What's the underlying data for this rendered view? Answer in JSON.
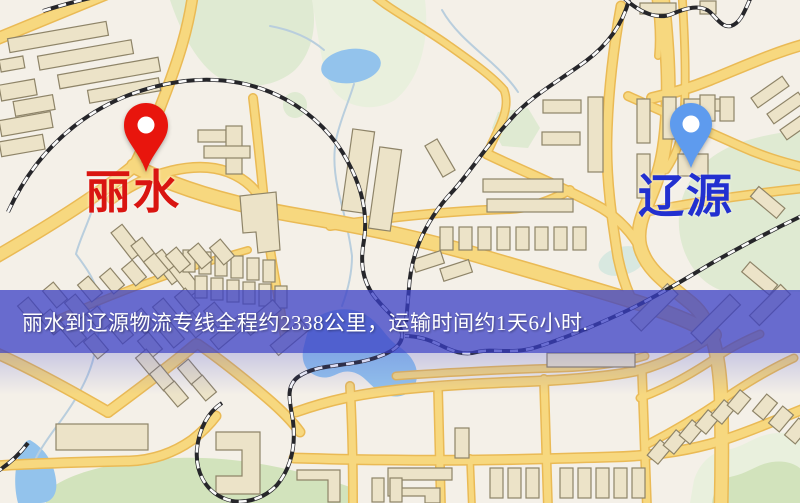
{
  "map": {
    "colors": {
      "bg": "#f4f0e8",
      "road_fill": "#f7d87f",
      "road_casing": "#eaba55",
      "building_fill": "#ece3c8",
      "building_stroke": "#8e8468",
      "water": "#93c3ec",
      "stream": "#b9cedd",
      "park": "#dfead2",
      "park_light": "#e9f0dd",
      "park_dark": "#d2e3bc",
      "rail_dark": "#26262a",
      "rail_light": "#fbfbfb"
    }
  },
  "markers": [
    {
      "city": "丽水",
      "pin_color": "#e8150d",
      "label_color": "#d91511"
    },
    {
      "city": "辽源",
      "pin_color": "#5e9bee",
      "label_color": "#2230d0"
    }
  ],
  "banner": {
    "text": "丽水到辽源物流专线全程约2338公里，运输时间约1天6小时.",
    "origin_city": "丽水",
    "destination_city": "辽源",
    "distance_km": 2338,
    "duration": "1天6小时",
    "background": "rgba(58,63,198,0.75)",
    "text_color": "#ffffff"
  }
}
